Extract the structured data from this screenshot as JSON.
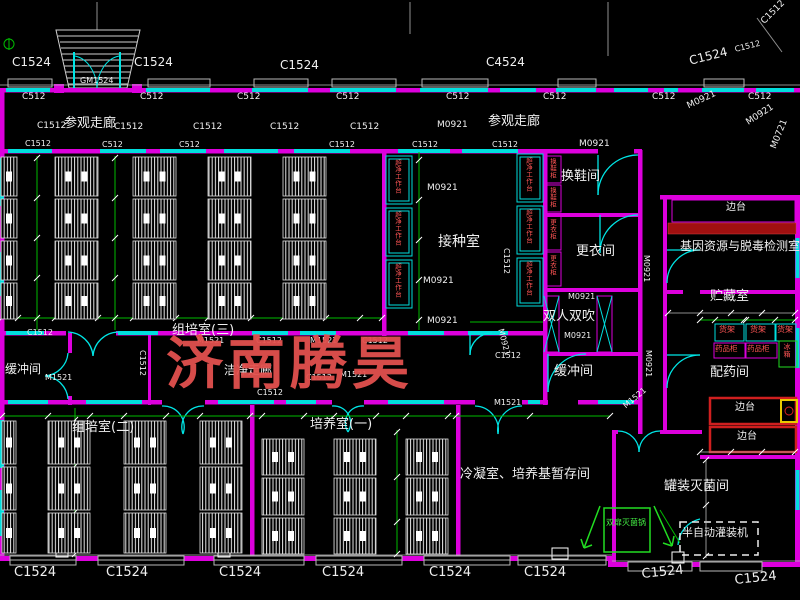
{
  "watermark": {
    "text": "济南腾昊",
    "color": "#e2514e"
  },
  "summary": {
    "rooms": [
      "参观走廊",
      "换鞋间",
      "更衣间",
      "双人双吹",
      "缓冲间",
      "接种室",
      "组培室(三)",
      "组培室(二)",
      "培养室(一)",
      "洁净走廊",
      "冷凝室、培养基暂存间",
      "罐装灭菌间",
      "配药间",
      "贮藏室",
      "基因资源与脱毒检测室"
    ],
    "window_door_codes": [
      "C1524",
      "C4524",
      "C1512",
      "C512",
      "M0921",
      "M0721",
      "M1521",
      "GM1524"
    ],
    "equipment": [
      "超净工作台",
      "换鞋柜",
      "更衣柜",
      "货架",
      "药品柜",
      "冰箱",
      "边台",
      "双扉灭菌锅",
      "半自动灌装机"
    ],
    "colors": {
      "wall": "#dd00dd",
      "window": "#00dede",
      "dimension": "#00bb00",
      "equipment_text": "#ff5555",
      "watermark": "#e2514e"
    }
  },
  "labels": [
    {
      "text": "C1524",
      "x": 12,
      "y": 56,
      "fs": 12,
      "name": "window-code"
    },
    {
      "text": "GM1524",
      "x": 80,
      "y": 77,
      "fs": 8,
      "name": "door-code"
    },
    {
      "text": "C1524",
      "x": 134,
      "y": 56,
      "fs": 12,
      "name": "window-code"
    },
    {
      "text": "C1524",
      "x": 280,
      "y": 59,
      "fs": 12,
      "name": "window-code"
    },
    {
      "text": "C4524",
      "x": 486,
      "y": 56,
      "fs": 12,
      "name": "window-code"
    },
    {
      "text": "C1524",
      "x": 688,
      "y": 55,
      "fs": 12,
      "rot": -14,
      "name": "window-code"
    },
    {
      "text": "C1512",
      "x": 760,
      "y": 20,
      "fs": 9,
      "rot": -45,
      "name": "window-code"
    },
    {
      "text": "C1512",
      "x": 734,
      "y": 46,
      "fs": 8,
      "rot": -14,
      "name": "window-code"
    },
    {
      "text": "C512",
      "x": 22,
      "y": 93,
      "fs": 9,
      "name": "window-code"
    },
    {
      "text": "C512",
      "x": 140,
      "y": 93,
      "fs": 9,
      "name": "window-code"
    },
    {
      "text": "C512",
      "x": 237,
      "y": 93,
      "fs": 9,
      "name": "window-code"
    },
    {
      "text": "C512",
      "x": 336,
      "y": 93,
      "fs": 9,
      "name": "window-code"
    },
    {
      "text": "C512",
      "x": 446,
      "y": 93,
      "fs": 9,
      "name": "window-code"
    },
    {
      "text": "C512",
      "x": 543,
      "y": 93,
      "fs": 9,
      "name": "window-code"
    },
    {
      "text": "C512",
      "x": 652,
      "y": 93,
      "fs": 9,
      "name": "window-code"
    },
    {
      "text": "C512",
      "x": 748,
      "y": 93,
      "fs": 9,
      "name": "window-code"
    },
    {
      "text": "C1512",
      "x": 37,
      "y": 122,
      "fs": 9,
      "name": "window-code"
    },
    {
      "text": "参观走廊",
      "x": 64,
      "y": 117,
      "fs": 13,
      "name": "room-label-visit-corridor"
    },
    {
      "text": "C1512",
      "x": 114,
      "y": 123,
      "fs": 9,
      "name": "window-code"
    },
    {
      "text": "C1512",
      "x": 193,
      "y": 123,
      "fs": 9,
      "name": "window-code"
    },
    {
      "text": "C1512",
      "x": 270,
      "y": 123,
      "fs": 9,
      "name": "window-code"
    },
    {
      "text": "C1512",
      "x": 350,
      "y": 123,
      "fs": 9,
      "name": "window-code"
    },
    {
      "text": "M0921",
      "x": 437,
      "y": 121,
      "fs": 9,
      "name": "door-code"
    },
    {
      "text": "参观走廊",
      "x": 488,
      "y": 115,
      "fs": 13,
      "name": "room-label-visit-corridor"
    },
    {
      "text": "M0921",
      "x": 686,
      "y": 103,
      "fs": 9,
      "rot": -25,
      "name": "door-code"
    },
    {
      "text": "M0921",
      "x": 745,
      "y": 120,
      "fs": 9,
      "rot": -33,
      "name": "door-code"
    },
    {
      "text": "M0721",
      "x": 770,
      "y": 147,
      "fs": 9,
      "rot": -68,
      "name": "door-code"
    },
    {
      "text": "C1512",
      "x": 25,
      "y": 140,
      "fs": 8,
      "name": "window-code"
    },
    {
      "text": "C512",
      "x": 102,
      "y": 141,
      "fs": 8,
      "name": "window-code"
    },
    {
      "text": "C512",
      "x": 179,
      "y": 141,
      "fs": 8,
      "name": "window-code"
    },
    {
      "text": "C1512",
      "x": 329,
      "y": 141,
      "fs": 8,
      "name": "window-code"
    },
    {
      "text": "C1512",
      "x": 412,
      "y": 141,
      "fs": 8,
      "name": "window-code"
    },
    {
      "text": "C1512",
      "x": 492,
      "y": 141,
      "fs": 8,
      "name": "window-code"
    },
    {
      "text": "M0921",
      "x": 579,
      "y": 140,
      "fs": 9,
      "name": "door-code"
    },
    {
      "text": "换鞋间",
      "x": 561,
      "y": 170,
      "fs": 13,
      "name": "room-label-shoe-change"
    },
    {
      "text": "M0921",
      "x": 427,
      "y": 184,
      "fs": 9,
      "name": "door-code"
    },
    {
      "text": "接种室",
      "x": 438,
      "y": 235,
      "fs": 14,
      "name": "room-label-inoculation"
    },
    {
      "text": "M0921",
      "x": 423,
      "y": 277,
      "fs": 9,
      "name": "door-code"
    },
    {
      "text": "M0921",
      "x": 427,
      "y": 317,
      "fs": 9,
      "name": "door-code"
    },
    {
      "text": "C1512",
      "x": 510,
      "y": 248,
      "fs": 8,
      "rot": 90,
      "name": "window-code"
    },
    {
      "text": "更衣间",
      "x": 576,
      "y": 245,
      "fs": 13,
      "name": "room-label-dressing"
    },
    {
      "text": "M0921",
      "x": 568,
      "y": 293,
      "fs": 8,
      "name": "door-code"
    },
    {
      "text": "双人双吹",
      "x": 543,
      "y": 310,
      "fs": 13,
      "name": "room-label-air-shower"
    },
    {
      "text": "M0921",
      "x": 564,
      "y": 332,
      "fs": 8,
      "name": "door-code"
    },
    {
      "text": "缓冲间",
      "x": 554,
      "y": 365,
      "fs": 13,
      "name": "room-label-buffer"
    },
    {
      "text": "缓冲间",
      "x": 5,
      "y": 363,
      "fs": 12,
      "name": "room-label-buffer"
    },
    {
      "text": "M1521",
      "x": 45,
      "y": 374,
      "fs": 8,
      "name": "door-code"
    },
    {
      "text": "组培室(三)",
      "x": 172,
      "y": 324,
      "fs": 13,
      "name": "room-label-tissue-culture-3"
    },
    {
      "text": "C1512",
      "x": 27,
      "y": 329,
      "fs": 8,
      "name": "window-code"
    },
    {
      "text": "M1521",
      "x": 197,
      "y": 337,
      "fs": 8,
      "name": "door-code"
    },
    {
      "text": "C1512",
      "x": 256,
      "y": 337,
      "fs": 8,
      "name": "window-code"
    },
    {
      "text": "M1521",
      "x": 310,
      "y": 337,
      "fs": 8,
      "name": "door-code"
    },
    {
      "text": "C1512",
      "x": 362,
      "y": 337,
      "fs": 8,
      "name": "window-code"
    },
    {
      "text": "C1512",
      "x": 146,
      "y": 350,
      "fs": 8,
      "rot": 90,
      "name": "window-code"
    },
    {
      "text": "洁净走廊",
      "x": 224,
      "y": 364,
      "fs": 12,
      "name": "room-label-clean-corridor"
    },
    {
      "text": "C1512",
      "x": 306,
      "y": 374,
      "fs": 8,
      "name": "window-code"
    },
    {
      "text": "M1521",
      "x": 340,
      "y": 371,
      "fs": 8,
      "name": "door-code"
    },
    {
      "text": "C1512",
      "x": 257,
      "y": 389,
      "fs": 8,
      "name": "window-code"
    },
    {
      "text": "M0921",
      "x": 504,
      "y": 328,
      "fs": 8,
      "rot": 75,
      "name": "door-code"
    },
    {
      "text": "C1512",
      "x": 495,
      "y": 352,
      "fs": 8,
      "name": "window-code"
    },
    {
      "text": "组培室(二)",
      "x": 72,
      "y": 421,
      "fs": 13,
      "name": "room-label-tissue-culture-2"
    },
    {
      "text": "培养室(一)",
      "x": 310,
      "y": 418,
      "fs": 13,
      "name": "room-label-culture-1"
    },
    {
      "text": "M1521",
      "x": 494,
      "y": 399,
      "fs": 8,
      "name": "door-code"
    },
    {
      "text": "冷凝室、培养基暂存间",
      "x": 460,
      "y": 468,
      "fs": 13,
      "name": "room-label-condensation-storage"
    },
    {
      "text": "罐装灭菌间",
      "x": 664,
      "y": 480,
      "fs": 13,
      "name": "room-label-canning-sterilization"
    },
    {
      "text": "M1521",
      "x": 622,
      "y": 404,
      "fs": 8,
      "rot": -40,
      "name": "door-code"
    },
    {
      "text": "M0921",
      "x": 650,
      "y": 255,
      "fs": 8,
      "rot": 90,
      "name": "door-code"
    },
    {
      "text": "M0921",
      "x": 652,
      "y": 350,
      "fs": 8,
      "rot": 90,
      "name": "door-code"
    },
    {
      "text": "基因资源与脱毒检测室",
      "x": 680,
      "y": 240,
      "fs": 12,
      "name": "room-label-gene-resource"
    },
    {
      "text": "边台",
      "x": 726,
      "y": 203,
      "fs": 10,
      "name": "equipment-label-bench"
    },
    {
      "text": "贮藏室",
      "x": 710,
      "y": 290,
      "fs": 13,
      "name": "room-label-storage"
    },
    {
      "text": "货架",
      "x": 719,
      "y": 326,
      "fs": 8,
      "color": "#ff5555",
      "name": "equipment-label-shelf"
    },
    {
      "text": "货架",
      "x": 750,
      "y": 326,
      "fs": 8,
      "color": "#ff5555",
      "name": "equipment-label-shelf"
    },
    {
      "text": "货架",
      "x": 777,
      "y": 326,
      "fs": 8,
      "color": "#ff5555",
      "name": "equipment-label-shelf"
    },
    {
      "text": "药品柜",
      "x": 715,
      "y": 345,
      "fs": 7.5,
      "color": "#ff5555",
      "name": "equipment-label-medicine-cabinet"
    },
    {
      "text": "药品柜",
      "x": 747,
      "y": 345,
      "fs": 7.5,
      "color": "#ff5555",
      "name": "equipment-label-medicine-cabinet"
    },
    {
      "text": "冰箱",
      "x": 783,
      "y": 343,
      "fs": 7,
      "color": "#ff5555",
      "vert": true,
      "name": "equipment-label-fridge"
    },
    {
      "text": "配药间",
      "x": 710,
      "y": 366,
      "fs": 13,
      "name": "room-label-dispensing"
    },
    {
      "text": "边台",
      "x": 735,
      "y": 403,
      "fs": 10,
      "name": "equipment-label-bench"
    },
    {
      "text": "边台",
      "x": 737,
      "y": 432,
      "fs": 10,
      "name": "equipment-label-bench"
    },
    {
      "text": "双扉灭菌锅",
      "x": 606,
      "y": 519,
      "fs": 8,
      "color": "#44ee44",
      "name": "equipment-label-sterilizer"
    },
    {
      "text": "半自动灌装机",
      "x": 682,
      "y": 527,
      "fs": 11,
      "name": "equipment-label-filling-machine"
    },
    {
      "text": "C1524",
      "x": 14,
      "y": 566,
      "fs": 13,
      "name": "window-code"
    },
    {
      "text": "C1524",
      "x": 106,
      "y": 566,
      "fs": 13,
      "name": "window-code"
    },
    {
      "text": "C1524",
      "x": 219,
      "y": 566,
      "fs": 13,
      "name": "window-code"
    },
    {
      "text": "C1524",
      "x": 322,
      "y": 566,
      "fs": 13,
      "name": "window-code"
    },
    {
      "text": "C1524",
      "x": 429,
      "y": 566,
      "fs": 13,
      "name": "window-code"
    },
    {
      "text": "C1524",
      "x": 524,
      "y": 566,
      "fs": 13,
      "name": "window-code"
    },
    {
      "text": "C1524",
      "x": 641,
      "y": 568,
      "fs": 13,
      "rot": -6,
      "name": "window-code"
    },
    {
      "text": "C1524",
      "x": 734,
      "y": 574,
      "fs": 13,
      "rot": -6,
      "name": "window-code"
    },
    {
      "text": "超净工作台",
      "x": 394,
      "y": 159,
      "fs": 6.5,
      "color": "#ff5555",
      "vert": true,
      "name": "equipment-label-clean-bench"
    },
    {
      "text": "超净工作台",
      "x": 394,
      "y": 211,
      "fs": 6.5,
      "color": "#ff5555",
      "vert": true,
      "name": "equipment-label-clean-bench"
    },
    {
      "text": "超净工作台",
      "x": 394,
      "y": 263,
      "fs": 6.5,
      "color": "#ff5555",
      "vert": true,
      "name": "equipment-label-clean-bench"
    },
    {
      "text": "超净工作台",
      "x": 525,
      "y": 157,
      "fs": 6.5,
      "color": "#ff5555",
      "vert": true,
      "name": "equipment-label-clean-bench"
    },
    {
      "text": "超净工作台",
      "x": 525,
      "y": 209,
      "fs": 6.5,
      "color": "#ff5555",
      "vert": true,
      "name": "equipment-label-clean-bench"
    },
    {
      "text": "超净工作台",
      "x": 525,
      "y": 261,
      "fs": 6.5,
      "color": "#ff5555",
      "vert": true,
      "name": "equipment-label-clean-bench"
    },
    {
      "text": "换鞋柜",
      "x": 549,
      "y": 158,
      "fs": 6.5,
      "color": "#ff5555",
      "vert": true,
      "name": "equipment-label-shoe-cabinet"
    },
    {
      "text": "换鞋柜",
      "x": 549,
      "y": 187,
      "fs": 6.5,
      "color": "#ff5555",
      "vert": true,
      "name": "equipment-label-shoe-cabinet"
    },
    {
      "text": "更衣柜",
      "x": 549,
      "y": 219,
      "fs": 6.5,
      "color": "#ff5555",
      "vert": true,
      "name": "equipment-label-wardrobe"
    },
    {
      "text": "更衣柜",
      "x": 549,
      "y": 255,
      "fs": 6.5,
      "color": "#ff5555",
      "vert": true,
      "name": "equipment-label-wardrobe"
    }
  ]
}
